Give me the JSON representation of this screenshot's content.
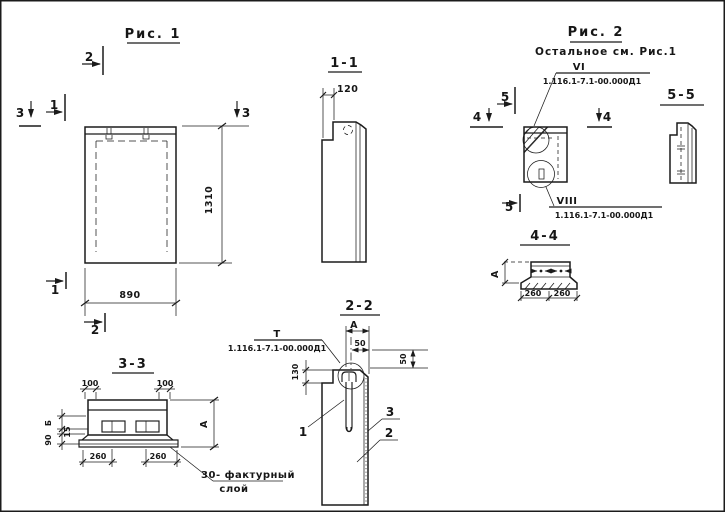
{
  "figure1": {
    "title": "Рис. 1",
    "dim_width": "890",
    "dim_height": "1310",
    "marker_1": "1",
    "marker_2": "2",
    "marker_3": "3"
  },
  "section11": {
    "title": "1-1",
    "dim_notch": "120"
  },
  "figure2": {
    "title": "Рис. 2",
    "subtitle": "Остальное см. Рис.1",
    "marker_4": "4",
    "marker_5": "5",
    "callout_vi_ref": "VI",
    "callout_vi_designation": "1.116.1-7.1-00.000Д1",
    "callout_viii_ref": "VIII",
    "callout_viii_designation": "1.116.1-7.1-00.000Д1"
  },
  "section55": {
    "title": "5-5"
  },
  "section44": {
    "title": "4-4",
    "dim_left": "А",
    "dim_bottom_left": "260",
    "dim_bottom_right": "260"
  },
  "section33": {
    "title": "3-3",
    "dim_top_left": "100",
    "dim_top_right": "100",
    "dim_b": "Б",
    "dim_15": "15",
    "dim_90": "90",
    "dim_right": "А",
    "dim_bottom_left": "260",
    "dim_bottom_right": "260",
    "note_line1": "30- фактурный",
    "note_line2": "слой"
  },
  "section22": {
    "title": "2-2",
    "dim_a": "А",
    "dim_50_top": "50",
    "dim_50_right": "50",
    "dim_130": "130",
    "part_1": "1",
    "part_2": "2",
    "part_3": "3",
    "callout_t_ref": "Т",
    "callout_t_designation": "1.116.1-7.1-00.000Д1"
  }
}
